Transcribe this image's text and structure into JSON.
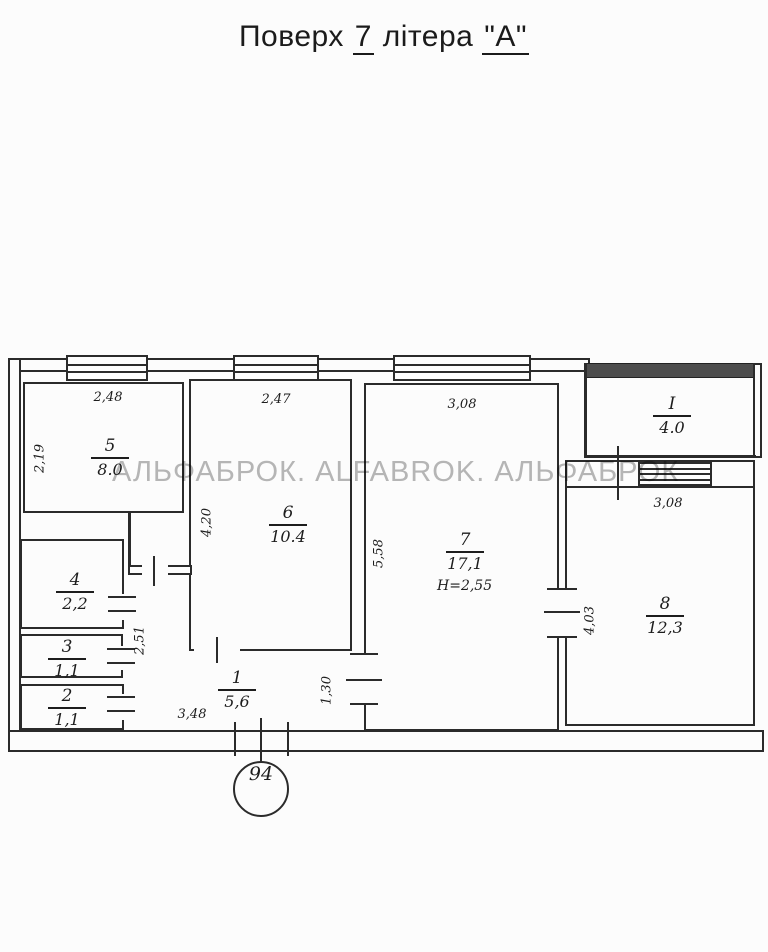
{
  "title": {
    "prefix": "Поверх",
    "floor_number": "7",
    "middle": "літера",
    "building_letter": "\"А\""
  },
  "watermark": "АЛЬФАБРОК. ALFABROK. АЛЬФАБРОК",
  "plan": {
    "apartment_number": "94",
    "room7_height": "H=2,55",
    "rooms": [
      {
        "number": "1",
        "area": "5,6"
      },
      {
        "number": "2",
        "area": "1,1"
      },
      {
        "number": "3",
        "area": "1,1"
      },
      {
        "number": "4",
        "area": "2,2"
      },
      {
        "number": "5",
        "area": "8.0"
      },
      {
        "number": "6",
        "area": "10.4"
      },
      {
        "number": "7",
        "area": "17,1"
      },
      {
        "number": "8",
        "area": "12,3"
      },
      {
        "number": "I",
        "area": "4.0"
      }
    ],
    "dimensions": {
      "room5_width": "2,48",
      "room6_width": "2,47",
      "room7_width": "3,08",
      "room8_width": "3,08",
      "room5_depth": "2,19",
      "room6_depth": "4,20",
      "room7_depth": "5,58",
      "room8_depth": "4,03",
      "hall_depth": "2,51",
      "door_width": "1,30",
      "corridor_width": "3,48"
    }
  }
}
